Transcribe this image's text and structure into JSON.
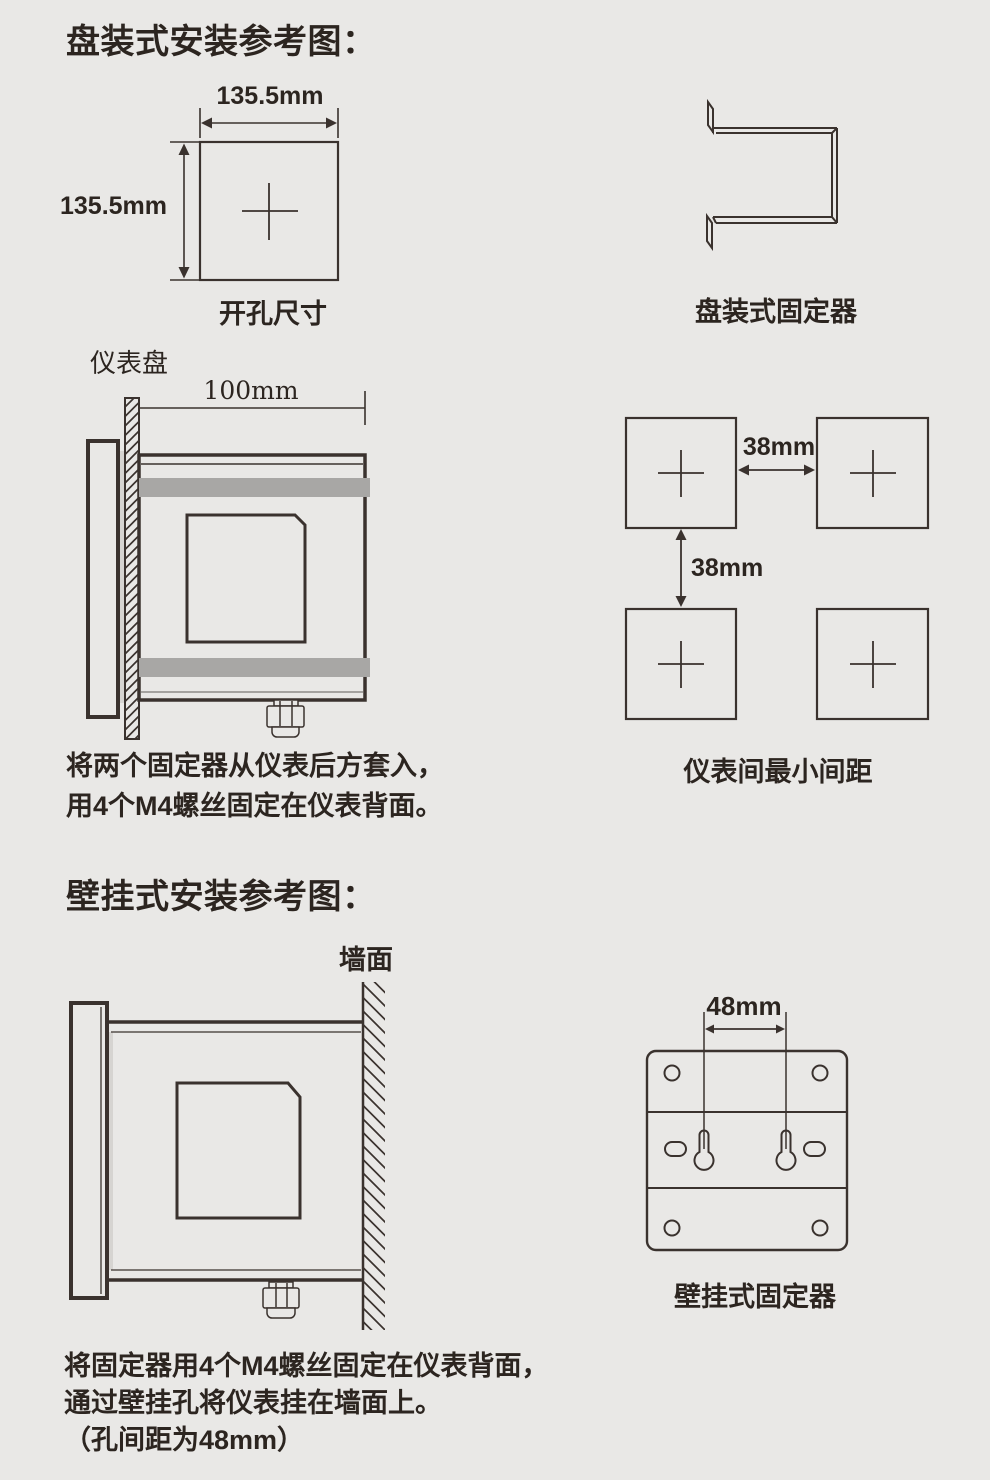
{
  "colors": {
    "background": "#e9e8e6",
    "ink": "#3a322e",
    "text": "#2c2520",
    "gray_band": "#a8a7a5",
    "gasket": "#d6d4d1"
  },
  "section_panel": {
    "title": "盘装式安装参考图：",
    "cutout": {
      "width_label": "135.5mm",
      "height_label": "135.5mm",
      "caption": "开孔尺寸"
    },
    "bracket_caption": "盘装式固定器",
    "side_view": {
      "panel_label": "仪表盘",
      "depth_label": "100mm"
    },
    "spacing": {
      "h_label": "38mm",
      "v_label": "38mm",
      "caption": "仪表间最小间距"
    },
    "instructions": [
      "将两个固定器从仪表后方套入，",
      "用4个M4螺丝固定在仪表背面。"
    ]
  },
  "section_wall": {
    "title": "壁挂式安装参考图：",
    "side_view": {
      "wall_label": "墙面"
    },
    "plate": {
      "hole_spacing_label": "48mm",
      "caption": "壁挂式固定器"
    },
    "instructions": [
      "将固定器用4个M4螺丝固定在仪表背面，",
      "通过壁挂孔将仪表挂在墙面上。",
      "（孔间距为48mm）"
    ]
  }
}
